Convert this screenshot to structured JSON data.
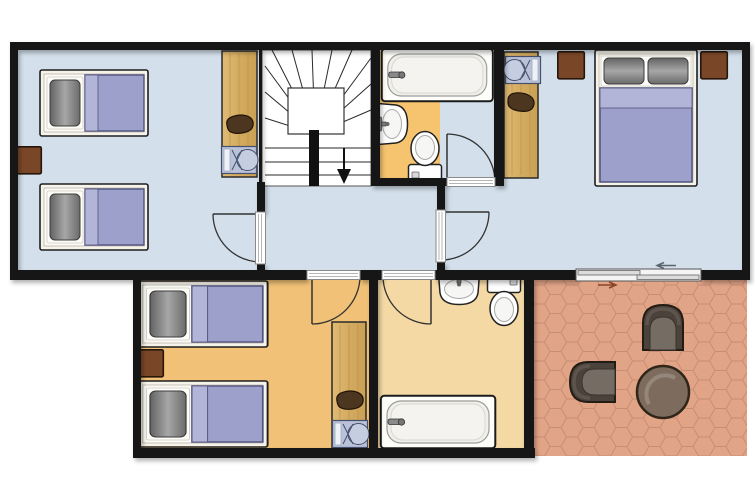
{
  "title": "apartment-floor-plan",
  "colors": {
    "bg": "#ffffff",
    "wall": "#161616",
    "floor_blue": "#d3e0ec",
    "floor_orange": "#f0c176",
    "bath_top": "#f6c46f",
    "bath_bottom": "#f4d9a5",
    "stairs": "#ffffff",
    "terrace": "#e2a487",
    "terrace_line": "#c68e72",
    "wood": "#d9b269",
    "wood_line": "#b8924c",
    "brown": "#7a4628",
    "blanket": "#9da0ca",
    "blanket_light": "#b3b5d8",
    "blanket_border": "#4f527e",
    "bed_frame": "#f6f4ea",
    "chair_dark": "#4c3620",
    "cot": "#b9c2d9",
    "tchair": "#4a423b",
    "tchair_seat": "#756c63",
    "table": "#7d6c5d",
    "line": "#2a2a2a"
  },
  "rooms": [
    {
      "name": "twin-bedroom-top-left",
      "floor": "light-blue",
      "furniture": [
        "single-bed",
        "single-bed",
        "nightstand",
        "desk-wardrobe",
        "chair",
        "cot"
      ]
    },
    {
      "name": "staircase",
      "floor": "white",
      "furniture": [
        "winder-stairs",
        "down-arrow"
      ]
    },
    {
      "name": "bathroom-top",
      "floor": "orange",
      "furniture": [
        "bathtub",
        "washbasin",
        "toilet"
      ]
    },
    {
      "name": "double-bedroom-top-right",
      "floor": "light-blue",
      "furniture": [
        "double-bed",
        "nightstand",
        "nightstand",
        "desk-wardrobe",
        "chair",
        "cot"
      ]
    },
    {
      "name": "hallway",
      "floor": "light-blue",
      "furniture": []
    },
    {
      "name": "twin-bedroom-bottom-left",
      "floor": "orange",
      "furniture": [
        "single-bed",
        "single-bed",
        "nightstand",
        "desk-wardrobe",
        "chair",
        "cot"
      ]
    },
    {
      "name": "bathroom-bottom",
      "floor": "cream",
      "furniture": [
        "washbasin",
        "toilet",
        "bathtub"
      ]
    },
    {
      "name": "terrace",
      "floor": "terracotta-hex-tiles",
      "furniture": [
        "armchair",
        "armchair",
        "round-table"
      ]
    }
  ],
  "doors": {
    "hinged_count": 5,
    "sliding_count": 1,
    "sliding_arrow_directions": [
      "left",
      "right"
    ]
  }
}
